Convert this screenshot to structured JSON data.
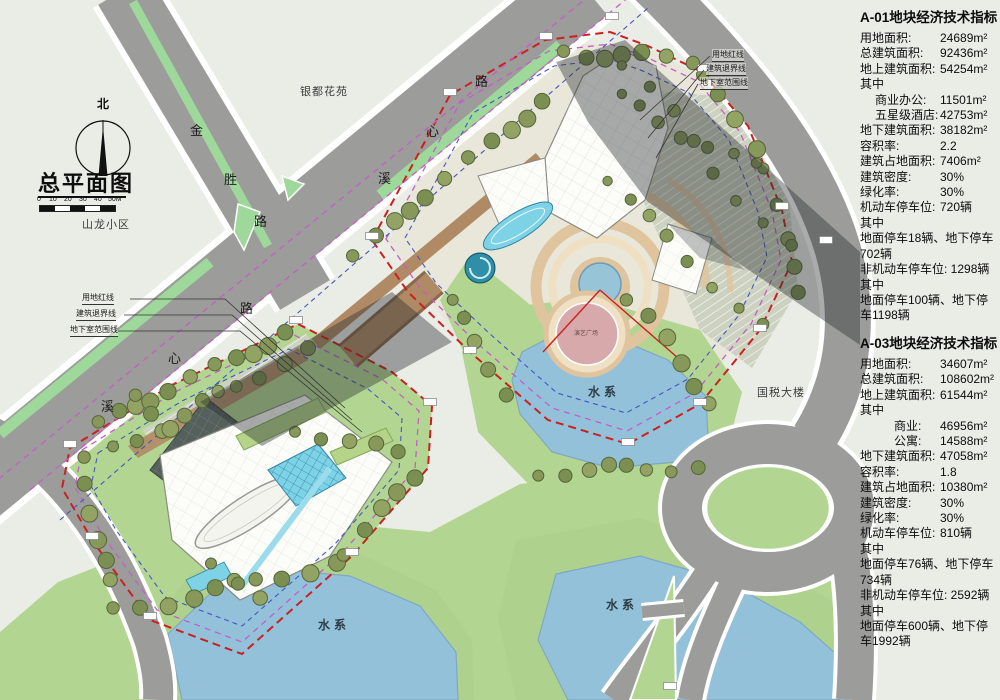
{
  "colors": {
    "background": "#eaece6",
    "road": "#9c9c9a",
    "road_edge": "#ffffff",
    "median_green": "#9ed89a",
    "greenery": "#b2d692",
    "bank_green": "#aed28e",
    "water": "#93c1da",
    "water_edge": "#7fa8c2",
    "tree": "#87985a",
    "tree_dark": "#7c8f52",
    "tree_light": "#93a363",
    "tree_stroke": "#55663a",
    "boundary_red": "#cc2020",
    "setback_magenta": "#c65cc8",
    "basement_blue": "#4656c0",
    "deck_brown": "#b08a64",
    "deck_dark": "#8a6a4c",
    "paving": "#e9e7da",
    "parking": "#ccd1c0",
    "building_white": "#fcfcf9",
    "building_stroke": "#8a8a84",
    "tower_dark": "#55605c",
    "glass_cyan": "#7ed2e6",
    "glass_stroke": "#2f86a2",
    "plaza_tan": "#e0c49e",
    "plaza_ring": "#efe0c4",
    "plaza_pink": "#d7a9ab",
    "pool_blue": "#97c4d6",
    "shadow": "rgba(40,45,48,0.40)",
    "marker_stroke": "#808080"
  },
  "title_block": {
    "north": "北",
    "title": "总平面图",
    "scale_ticks": [
      "0",
      "10",
      "20",
      "30",
      "40",
      "50M"
    ]
  },
  "legend": {
    "left": [
      "用地红线",
      "建筑退界线",
      "地下室范围线"
    ],
    "right": [
      "用地红线",
      "建筑退界线",
      "地下室范围线"
    ]
  },
  "map_labels": {
    "jinsheng_road": [
      "金",
      "胜",
      "路"
    ],
    "xixin_road": [
      "溪",
      "心",
      "路"
    ],
    "shanlong_estate": "山龙小区",
    "yindu_estate": "银都花苑",
    "guoshui_building": "国税大楼",
    "water_system": "水系",
    "performance_plaza": "演艺广场"
  },
  "panel_a01": {
    "title": "A-01地块经济技术指标",
    "rows": [
      {
        "t": "用地面积:",
        "v": "24689m²"
      },
      {
        "t": "总建筑面积:",
        "v": "92436m²"
      },
      {
        "t": "地上建筑面积:",
        "v": "54254m²"
      },
      {
        "t": "其中",
        "v": ""
      },
      {
        "t": "商业办公:",
        "v": "11501m²"
      },
      {
        "t": "五星级酒店:",
        "v": "42753m²"
      },
      {
        "t": "地下建筑面积:",
        "v": "38182m²"
      },
      {
        "t": "容积率:",
        "v": "2.2"
      },
      {
        "t": "建筑占地面积:",
        "v": "7406m²"
      },
      {
        "t": "建筑密度:",
        "v": "30%"
      },
      {
        "t": "绿化率:",
        "v": "30%"
      },
      {
        "t": "机动车停车位:",
        "v": "720辆"
      },
      {
        "t": "其中",
        "v": ""
      },
      {
        "t": "地面停车18辆、地下停车702辆",
        "v": ""
      },
      {
        "t": "非机动车停车位: 1298辆",
        "v": ""
      },
      {
        "t": "其中",
        "v": ""
      },
      {
        "t": "地面停车100辆、地下停车1198辆",
        "v": ""
      }
    ]
  },
  "panel_a03": {
    "title": "A-03地块经济技术指标",
    "rows": [
      {
        "t": "用地面积:",
        "v": "34607m²"
      },
      {
        "t": "总建筑面积:",
        "v": "108602m²"
      },
      {
        "t": "地上建筑面积:",
        "v": "61544m²"
      },
      {
        "t": "其中",
        "v": ""
      },
      {
        "t": "商业:",
        "v": "46956m²"
      },
      {
        "t": "公寓:",
        "v": "14588m²"
      },
      {
        "t": "地下建筑面积:",
        "v": "47058m²"
      },
      {
        "t": "容积率:",
        "v": "1.8"
      },
      {
        "t": "建筑占地面积:",
        "v": "10380m²"
      },
      {
        "t": "建筑密度:",
        "v": "30%"
      },
      {
        "t": "绿化率:",
        "v": "30%"
      },
      {
        "t": "机动车停车位:",
        "v": "810辆"
      },
      {
        "t": "其中",
        "v": ""
      },
      {
        "t": "地面停车76辆、地下停车734辆",
        "v": ""
      },
      {
        "t": "非机动车停车位: 2592辆",
        "v": ""
      },
      {
        "t": "其中",
        "v": ""
      },
      {
        "t": "地面停车600辆、地下停车1992辆",
        "v": ""
      }
    ]
  }
}
